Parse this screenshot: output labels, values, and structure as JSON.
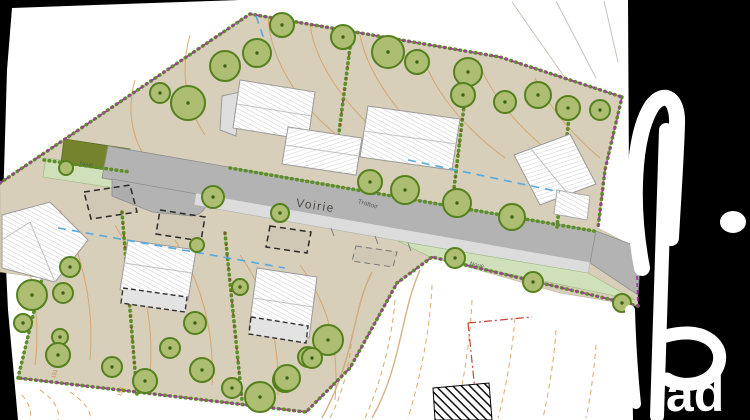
{
  "plan": {
    "labels": {
      "road": "Voirie",
      "sidewalk": "Trottoir",
      "swale_right": "Noue",
      "swale_left": "Noue",
      "elevations": [
        "151",
        "153"
      ]
    },
    "logo": {
      "text": "iad"
    },
    "colors": {
      "background": "#000000",
      "paper": "#ffffff",
      "parcel_ground": "#d7cfba",
      "road": "#b3b3b3",
      "sidewalk": "#dcdcdc",
      "swale_strip": "#cfe0bb",
      "green_patch": "#75832d",
      "tree_fill": "#adbd72",
      "tree_ring": "#55801e",
      "hedge": "#5d8f28",
      "boundary": "#a23a9e",
      "contour": "#d79e62",
      "utility_blue": "#55aadf",
      "neighbor_red": "#c4473a",
      "watermark": "#ffffff"
    },
    "trees": [
      {
        "x": 160,
        "y": 93,
        "r": 10
      },
      {
        "x": 188,
        "y": 103,
        "r": 17
      },
      {
        "x": 225,
        "y": 66,
        "r": 15
      },
      {
        "x": 257,
        "y": 53,
        "r": 14
      },
      {
        "x": 282,
        "y": 25,
        "r": 12
      },
      {
        "x": 343,
        "y": 37,
        "r": 12
      },
      {
        "x": 388,
        "y": 52,
        "r": 16
      },
      {
        "x": 417,
        "y": 62,
        "r": 12
      },
      {
        "x": 468,
        "y": 72,
        "r": 14
      },
      {
        "x": 463,
        "y": 95,
        "r": 12
      },
      {
        "x": 505,
        "y": 102,
        "r": 11
      },
      {
        "x": 538,
        "y": 95,
        "r": 13
      },
      {
        "x": 568,
        "y": 108,
        "r": 12
      },
      {
        "x": 600,
        "y": 110,
        "r": 10
      },
      {
        "x": 66,
        "y": 168,
        "r": 7
      },
      {
        "x": 213,
        "y": 197,
        "r": 11
      },
      {
        "x": 280,
        "y": 213,
        "r": 9
      },
      {
        "x": 370,
        "y": 182,
        "r": 12
      },
      {
        "x": 405,
        "y": 190,
        "r": 14
      },
      {
        "x": 457,
        "y": 203,
        "r": 14
      },
      {
        "x": 512,
        "y": 217,
        "r": 13
      },
      {
        "x": 455,
        "y": 258,
        "r": 10
      },
      {
        "x": 533,
        "y": 282,
        "r": 10
      },
      {
        "x": 622,
        "y": 303,
        "r": 9
      },
      {
        "x": 32,
        "y": 295,
        "r": 15
      },
      {
        "x": 63,
        "y": 293,
        "r": 10
      },
      {
        "x": 23,
        "y": 323,
        "r": 9
      },
      {
        "x": 60,
        "y": 337,
        "r": 8
      },
      {
        "x": 58,
        "y": 355,
        "r": 12
      },
      {
        "x": 70,
        "y": 267,
        "r": 10
      },
      {
        "x": 112,
        "y": 367,
        "r": 10
      },
      {
        "x": 145,
        "y": 381,
        "r": 12
      },
      {
        "x": 170,
        "y": 348,
        "r": 10
      },
      {
        "x": 195,
        "y": 323,
        "r": 11
      },
      {
        "x": 202,
        "y": 370,
        "r": 12
      },
      {
        "x": 232,
        "y": 388,
        "r": 10
      },
      {
        "x": 260,
        "y": 397,
        "r": 15
      },
      {
        "x": 285,
        "y": 380,
        "r": 12
      },
      {
        "x": 308,
        "y": 357,
        "r": 10
      },
      {
        "x": 240,
        "y": 287,
        "r": 8
      },
      {
        "x": 328,
        "y": 340,
        "r": 15
      },
      {
        "x": 312,
        "y": 358,
        "r": 10
      },
      {
        "x": 287,
        "y": 378,
        "r": 13
      },
      {
        "x": 197,
        "y": 245,
        "r": 7
      }
    ]
  }
}
